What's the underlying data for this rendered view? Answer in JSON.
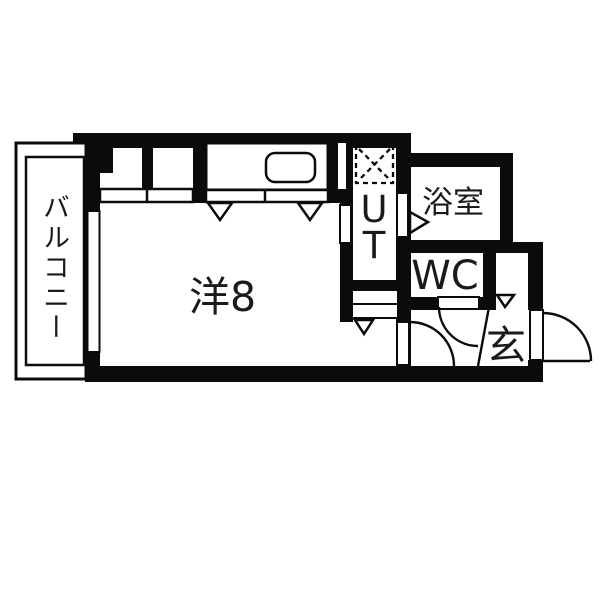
{
  "labels": {
    "balcony": "バルコニー",
    "main_room": "洋8",
    "utility": "UT",
    "bathroom": "浴室",
    "toilet": "WC",
    "entrance": "玄"
  },
  "colors": {
    "wall": "#0b0b0b",
    "background": "#ffffff",
    "text": "#1a1a1a"
  },
  "symbols": {
    "washing_machine_space": "dashed square with X",
    "kitchen_sink": "rounded rectangle",
    "door_swing": "quarter-circle arc",
    "opening_marker": "open triangle arrow"
  }
}
